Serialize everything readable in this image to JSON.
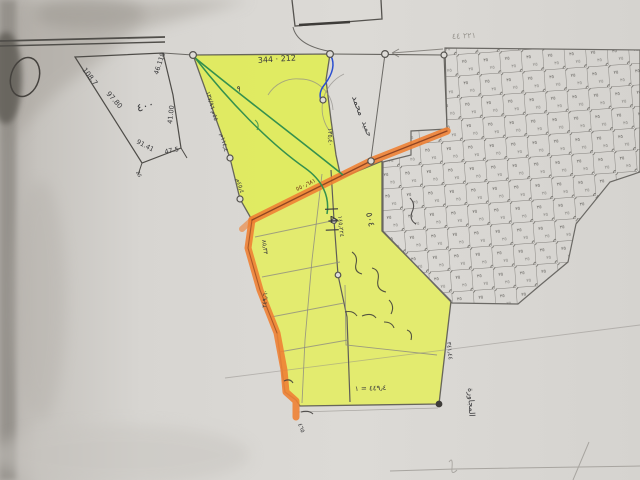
{
  "colors": {
    "paper": "#d9d7d3",
    "paper_bright": "#dfddd9",
    "shadow_dark": "#6e6a64",
    "shadow_mid": "#aaa59e",
    "yellow_highlight": "#e6f052",
    "yellow_deep": "#d9ec33",
    "orange_highlight": "#ee8134",
    "orange_core_line": "#7e3a1e",
    "pencil": "#6b6965",
    "pencil_dark": "#4e4c48",
    "ink": "#3a3a3c",
    "green_line": "#35914e",
    "blue_line": "#2b4fd0",
    "grid_line": "#827f7b",
    "faint_pencil": "#a8a5a0"
  },
  "map": {
    "grid": {
      "cell_size": 21.5,
      "rotation_deg": -4,
      "cell_mark": "٢٥"
    },
    "annotations": [
      {
        "text": "108.7",
        "x": 82,
        "y": 70,
        "rot": 52,
        "size": 7
      },
      {
        "text": "97.80",
        "x": 106,
        "y": 94,
        "rot": 48,
        "size": 7
      },
      {
        "text": "46.118",
        "x": 158,
        "y": 75,
        "rot": -72,
        "size": 6.5
      },
      {
        "text": "41.00",
        "x": 172,
        "y": 124,
        "rot": -84,
        "size": 6.5
      },
      {
        "text": "91.41",
        "x": 136,
        "y": 143,
        "rot": 28,
        "size": 6.5
      },
      {
        "text": "47.5",
        "x": 165,
        "y": 154,
        "rot": -12,
        "size": 6.5
      },
      {
        "text": "٤٠٠",
        "x": 138,
        "y": 112,
        "rot": -18,
        "size": 11
      },
      {
        "text": "25",
        "x": 136,
        "y": 172,
        "rot": 65,
        "size": 5
      },
      {
        "text": "344 · 212",
        "x": 258,
        "y": 63,
        "rot": -4,
        "size": 8
      },
      {
        "text": "٩",
        "x": 236,
        "y": 91,
        "rot": 10,
        "size": 8
      },
      {
        "text": "٥٥م ١٣٧/٩٦",
        "x": 206,
        "y": 92,
        "rot": 74,
        "size": 6
      },
      {
        "text": "١١٤٫٤م",
        "x": 220,
        "y": 134,
        "rot": 76,
        "size": 6
      },
      {
        "text": "٤٥٫٤م",
        "x": 236,
        "y": 179,
        "rot": 72,
        "size": 6
      },
      {
        "text": "١٣٥٫٤٠",
        "x": 328,
        "y": 128,
        "rot": 88,
        "size": 6
      },
      {
        "text": "محمد",
        "x": 352,
        "y": 97,
        "rot": 70,
        "size": 9
      },
      {
        "text": "حميد",
        "x": 362,
        "y": 122,
        "rot": 70,
        "size": 8
      },
      {
        "text": "٥٥٠٫٦٨١",
        "x": 297,
        "y": 191,
        "rot": -26,
        "size": 6,
        "color": "#6e2f16"
      },
      {
        "text": "٨٥٫٣٣",
        "x": 262,
        "y": 240,
        "rot": 82,
        "size": 6
      },
      {
        "text": "٢٤٩٫٦٠",
        "x": 266,
        "y": 308,
        "rot": -85,
        "size": 6
      },
      {
        "text": "| 4 |",
        "x": 328,
        "y": 207,
        "rot": 88,
        "size": 13
      },
      {
        "text": "١٤٥٫٢٢٤",
        "x": 338,
        "y": 216,
        "rot": 84,
        "size": 6
      },
      {
        "text": "٥٠٤",
        "x": 366,
        "y": 213,
        "rot": 78,
        "size": 9
      },
      {
        "text": "٤٤٩٫٤ = ١",
        "x": 355,
        "y": 391,
        "rot": -2,
        "size": 7
      },
      {
        "text": "٣٤١٫٤٤",
        "x": 447,
        "y": 342,
        "rot": 84,
        "size": 6
      },
      {
        "text": "المجاورة",
        "x": 468,
        "y": 388,
        "rot": 87,
        "size": 8
      },
      {
        "text": "٤٦٥",
        "x": 298,
        "y": 424,
        "rot": 70,
        "size": 6
      },
      {
        "text": "٢٢١ ٤٤",
        "x": 452,
        "y": 39,
        "rot": -3,
        "size": 8,
        "color": "#999690"
      }
    ]
  }
}
